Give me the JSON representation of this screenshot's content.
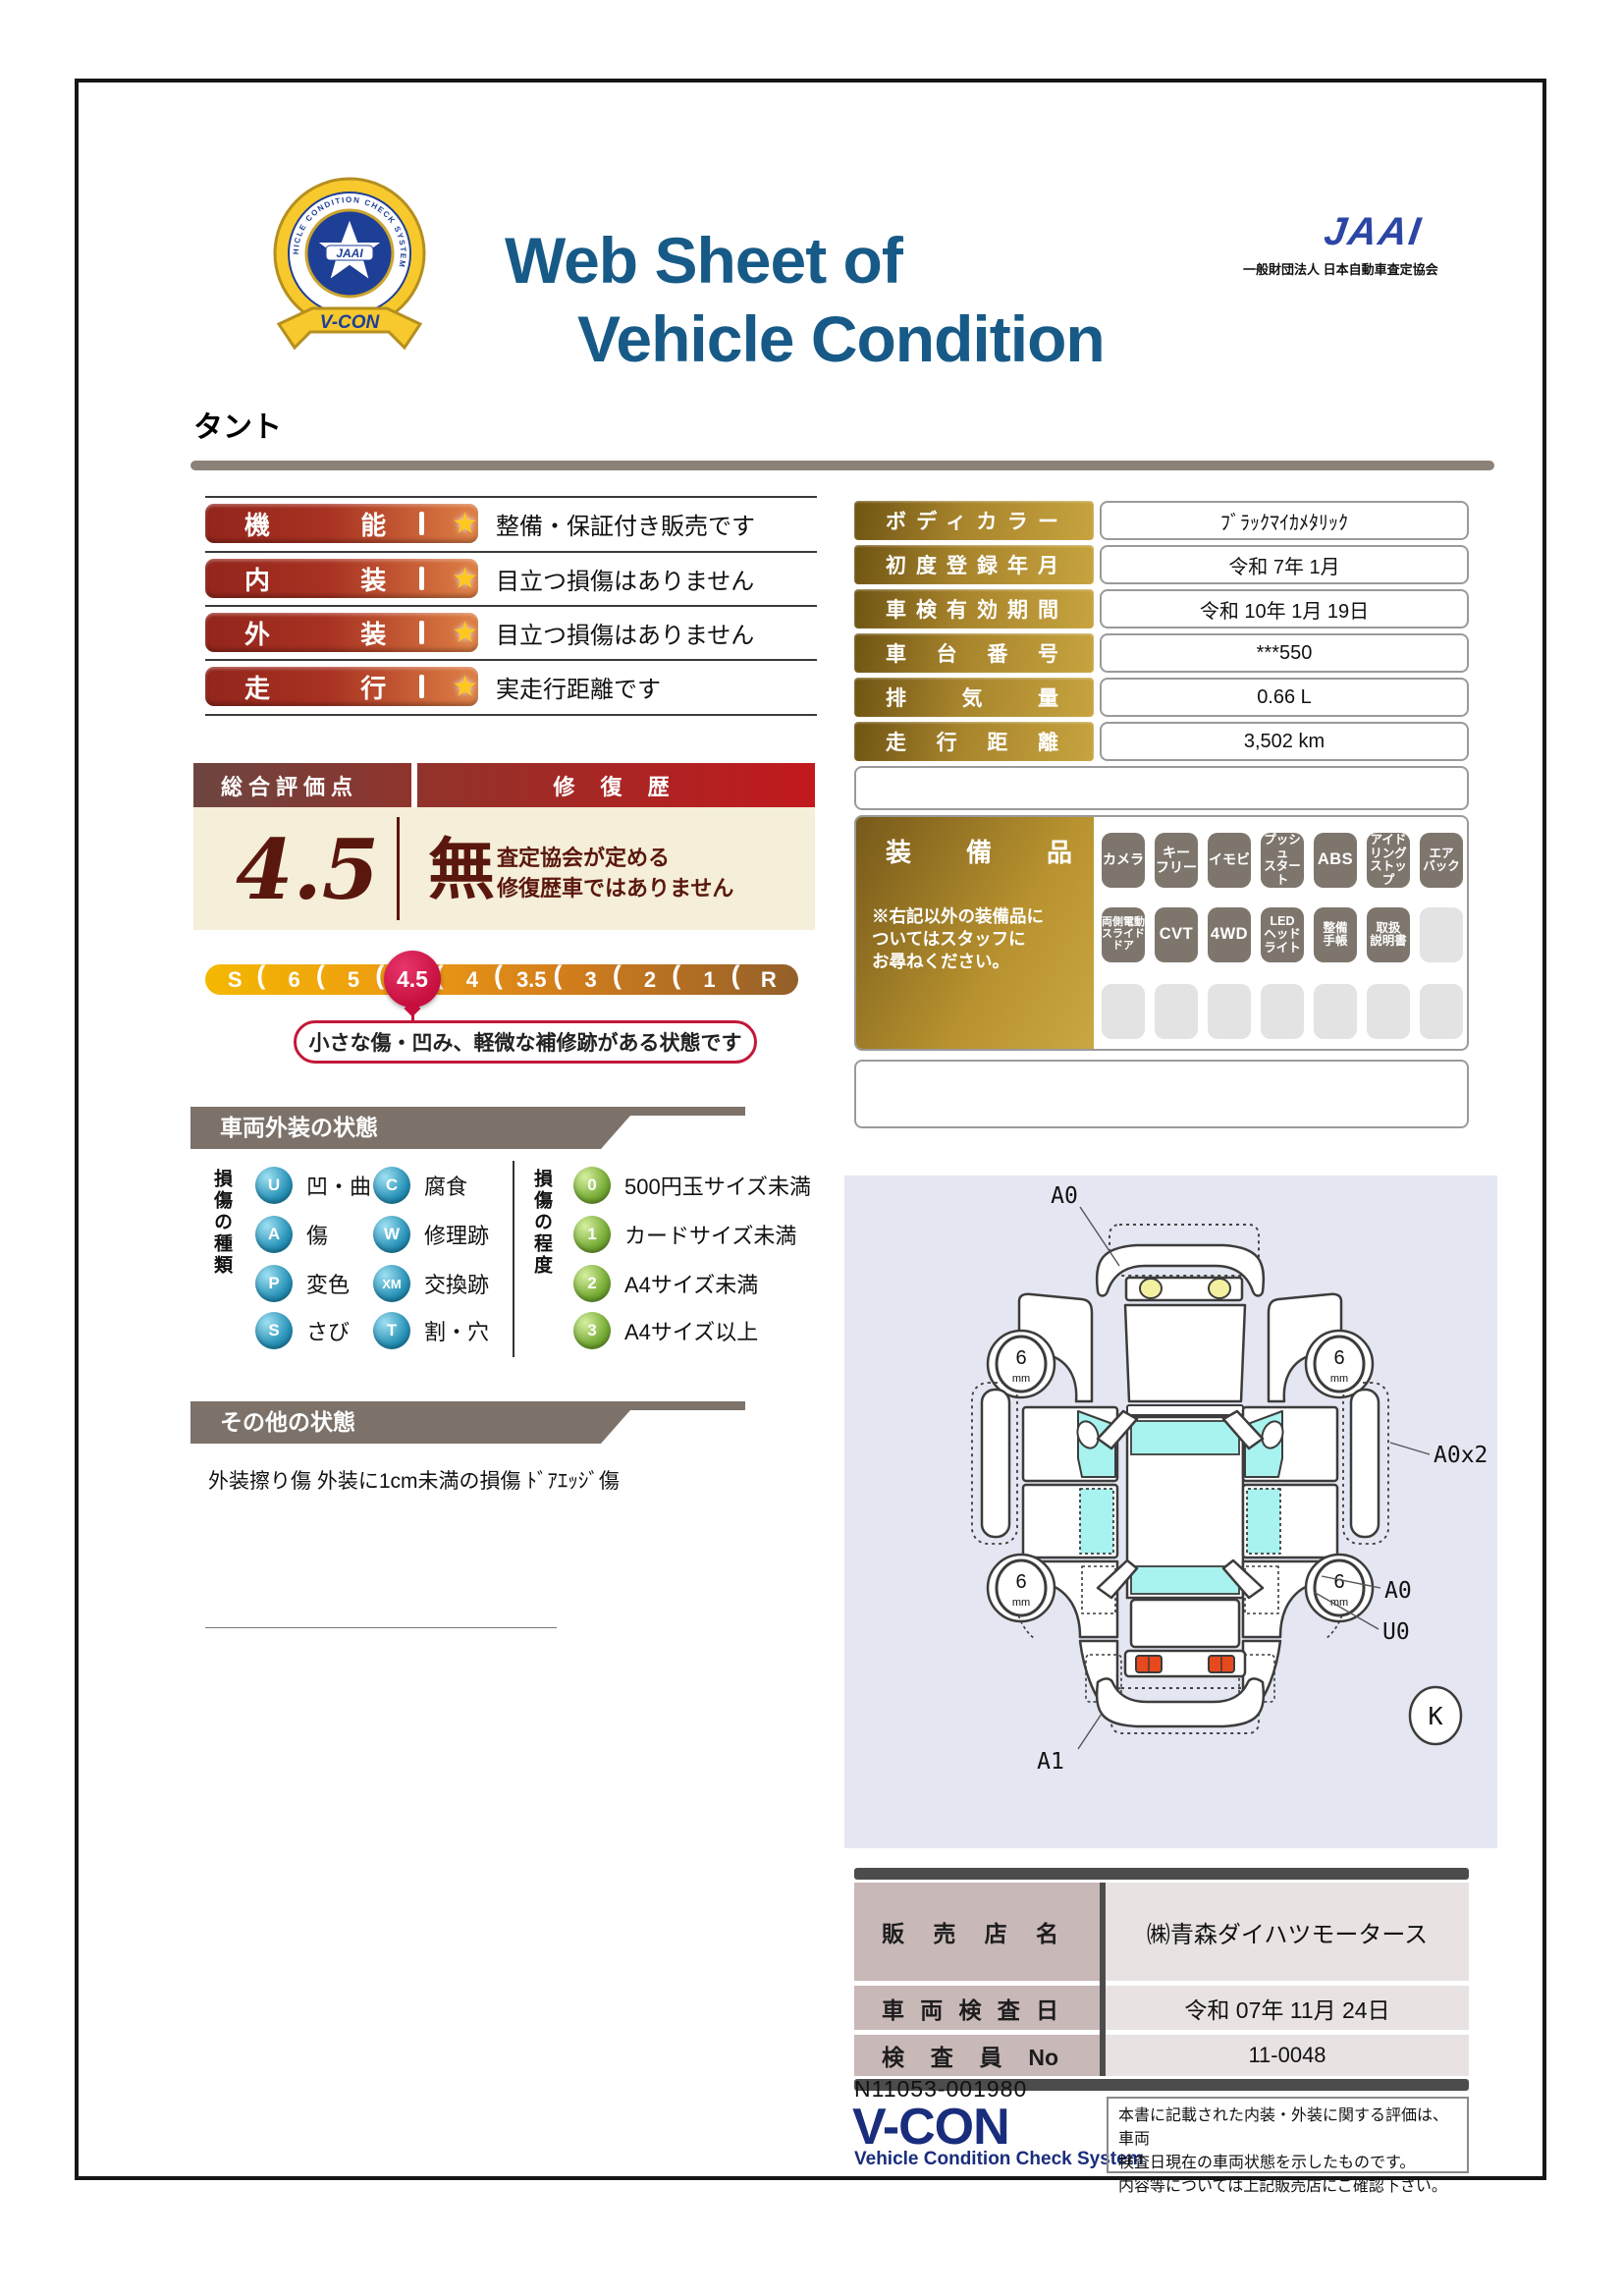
{
  "header": {
    "badge": {
      "ring_text": "VEHICLE CONDITION CHECK SYSTEM",
      "center": "JAAI",
      "ribbon": "V-CON"
    },
    "title_line1": "Web Sheet of",
    "title_line2": "Vehicle Condition",
    "jaai": "JAAI",
    "jaai_org": "一般財団法人 日本自動車査定協会"
  },
  "vehicle_name": "タント",
  "ratings": {
    "star": "★",
    "rows": [
      {
        "label": "機能",
        "description": "整備・保証付き販売です"
      },
      {
        "label": "内装",
        "description": "目立つ損傷はありません"
      },
      {
        "label": "外装",
        "description": "目立つ損傷はありません"
      },
      {
        "label": "走行",
        "description": "実走行距離です"
      }
    ]
  },
  "overall": {
    "header_left": "総合評価点",
    "header_right": "修 復 歴",
    "score": "4.5",
    "repair": {
      "value": "無",
      "note": "査定協会が定める\n修復歴車ではありません"
    },
    "scale": {
      "labels": [
        "S",
        "6",
        "5",
        "4.5",
        "4",
        "3.5",
        "3",
        "2",
        "1",
        "R"
      ],
      "selected": "4.5"
    },
    "callout": "小さな傷・凹み、軽微な補修跡がある状態です"
  },
  "info_table": {
    "rows": [
      {
        "label": "ボディカラー",
        "value": "ﾌﾞﾗｯｸﾏｲｶﾒﾀﾘｯｸ"
      },
      {
        "label": "初度登録年月",
        "value": "令和 7年 1月"
      },
      {
        "label": "車検有効期間",
        "value": "令和 10年 1月 19日"
      },
      {
        "label": "車台番号",
        "value": "***550"
      },
      {
        "label": "排気量",
        "value": "0.66 L"
      },
      {
        "label": "走行距離",
        "value": "3,502 km"
      }
    ]
  },
  "equipment": {
    "title": "装備品",
    "note": "※右記以外の装備品に\nついてはスタッフに\nお尋ねください。",
    "rows": [
      [
        "カメラ",
        "キー\nフリー",
        "イモビ",
        "プッシュ\nスタート",
        "ABS",
        "アイド\nリング\nストップ",
        "エア\nバック"
      ],
      [
        "両側電動\nスライド\nドア",
        "CVT",
        "4WD",
        "LED\nヘッド\nライト",
        "整備\n手帳",
        "取扱\n説明書",
        ""
      ],
      [
        "",
        "",
        "",
        "",
        "",
        "",
        ""
      ]
    ]
  },
  "exterior": {
    "banner": "車両外装の状態",
    "type_title": "損傷の種類",
    "types": [
      {
        "code": "U",
        "label": "凹・曲"
      },
      {
        "code": "C",
        "label": "腐食"
      },
      {
        "code": "A",
        "label": "傷"
      },
      {
        "code": "W",
        "label": "修理跡"
      },
      {
        "code": "P",
        "label": "変色"
      },
      {
        "code": "XM",
        "label": "交換跡"
      },
      {
        "code": "S",
        "label": "さび"
      },
      {
        "code": "T",
        "label": "割・穴"
      }
    ],
    "degree_title": "損傷の程度",
    "degrees": [
      {
        "code": "0",
        "label": "500円玉サイズ未満"
      },
      {
        "code": "1",
        "label": "カードサイズ未満"
      },
      {
        "code": "2",
        "label": "A4サイズ未満"
      },
      {
        "code": "3",
        "label": "A4サイズ以上"
      }
    ]
  },
  "other": {
    "banner": "その他の状態",
    "text": "外装擦り傷 外装に1cm未満の損傷 ﾄﾞｱｴｯｼﾞ傷"
  },
  "diagram": {
    "front_label": "A0",
    "side_label": "A0x2",
    "rear_fender_label": "A0",
    "under_label": "U0",
    "rear_bumper_label": "A1",
    "corner_mark": "K",
    "tread": "6",
    "tread_unit": "mm"
  },
  "dealer_table": {
    "rows": [
      {
        "label": "販売店名",
        "value": "㈱青森ダイハツモータース"
      },
      {
        "label": "車両検査日",
        "value": "令和 07年 11月 24日"
      },
      {
        "label": "検査員No",
        "value": "11-0048"
      }
    ]
  },
  "footer": {
    "serial": "N11053-001980",
    "vcon": "V-CON",
    "vcon_sub": "Vehicle Condition Check System",
    "disclaimer": "本書に記載された内装・外装に関する評価は、車両\n検査日現在の車両状態を示したものです。\n内容等については上記販売店にご確認下さい。"
  },
  "colors": {
    "title_blue": "#175a87",
    "jaai_blue": "#2b46a5",
    "maroon": "#5a170e",
    "red_bar": "#c2191d",
    "gold": "#a8842c",
    "scale_gold": "#f4b800",
    "selected_red": "#c60f3e",
    "taupe_banner": "#7c726a",
    "type_circle": "#0c6c92",
    "degree_circle": "#4c7d1d",
    "diagram_bg": "#e4e6f1",
    "glass_cyan": "#a8f2ef",
    "dealer_label_bg": "#c9b8b8",
    "vcon_navy": "#1a2d7c"
  }
}
